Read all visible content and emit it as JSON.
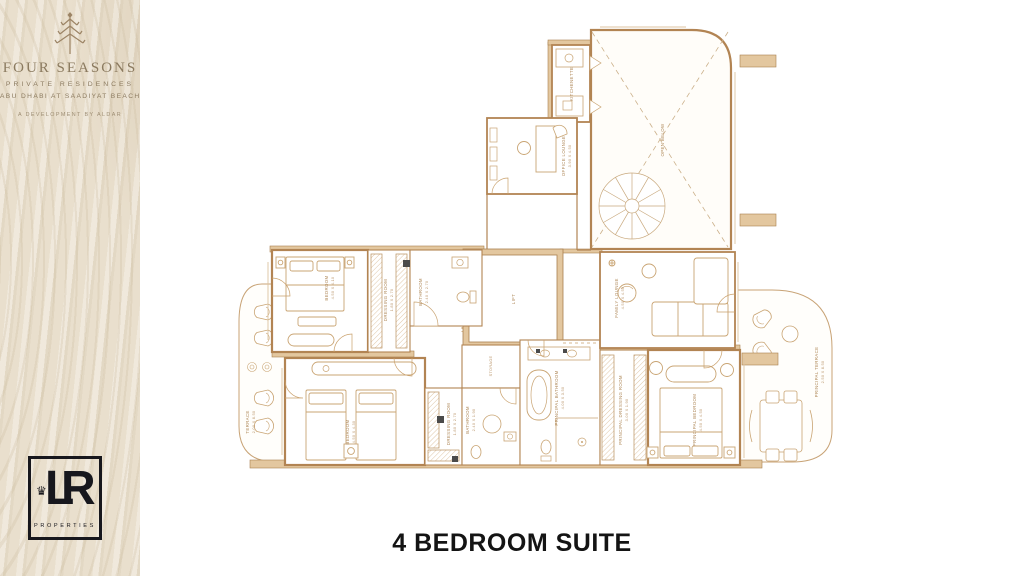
{
  "branding": {
    "four_seasons": {
      "name": "FOUR SEASONS",
      "subtitle": "PRIVATE RESIDENCES",
      "location": "ABU DHABI AT SAADIYAT BEACH",
      "developer": "A DEVELOPMENT BY ALDAR"
    },
    "agency": {
      "monogram_l": "L",
      "monogram_r": "R",
      "crown": "♛",
      "label": "PROPERTIES"
    }
  },
  "title": "4 BEDROOM SUITE",
  "plan": {
    "accent": "#b28453",
    "wall_fill": "#e3c79f",
    "rooms": {
      "open_below": "OPEN BELOW",
      "kitchenette": "KITCHENETTE",
      "office_lounge": "OFFICE LOUNGE",
      "office_lounge_dim": "3.90 X 4.50",
      "lift": "LIFT",
      "service_access": "SERVICE ACCESS",
      "bedroom_2": "BEDROOM",
      "bedroom_2_dim": "4.50 X 4.10",
      "dressing_2": "DRESSING ROOM",
      "dressing_2_dim": "1.80 X 2.70",
      "bathroom_2": "BATHROOM",
      "bathroom_2_dim": "2.40 X 2.70",
      "bedroom_3": "BEDROOM",
      "bedroom_3_dim": "4.50 X 4.30",
      "dressing_3": "DRESSING ROOM",
      "dressing_3_dim": "1.80 X 2.70",
      "bathroom_3": "BATHROOM",
      "bathroom_3_dim": "2.40 X 1.90",
      "storage": "STORAGE",
      "principal_bathroom": "PRINCIPAL BATHROOM",
      "principal_bathroom_dim": "4.00 X 3.50",
      "principal_dressing": "PRINCIPAL DRESSING ROOM",
      "principal_dressing_dim": "3.00 X 1.90",
      "principal_bedroom": "PRINCIPAL BEDROOM",
      "principal_bedroom_dim": "4.50 X 4.50",
      "family_lounge": "FAMILY LOUNGE",
      "family_lounge_dim": "4.50 X 4.50",
      "terrace": "TERRACE",
      "terrace_dim": "2.00 X 8.50",
      "principal_terrace": "PRINCIPAL TERRACE",
      "principal_terrace_dim": "2.50 X 8.50"
    }
  }
}
